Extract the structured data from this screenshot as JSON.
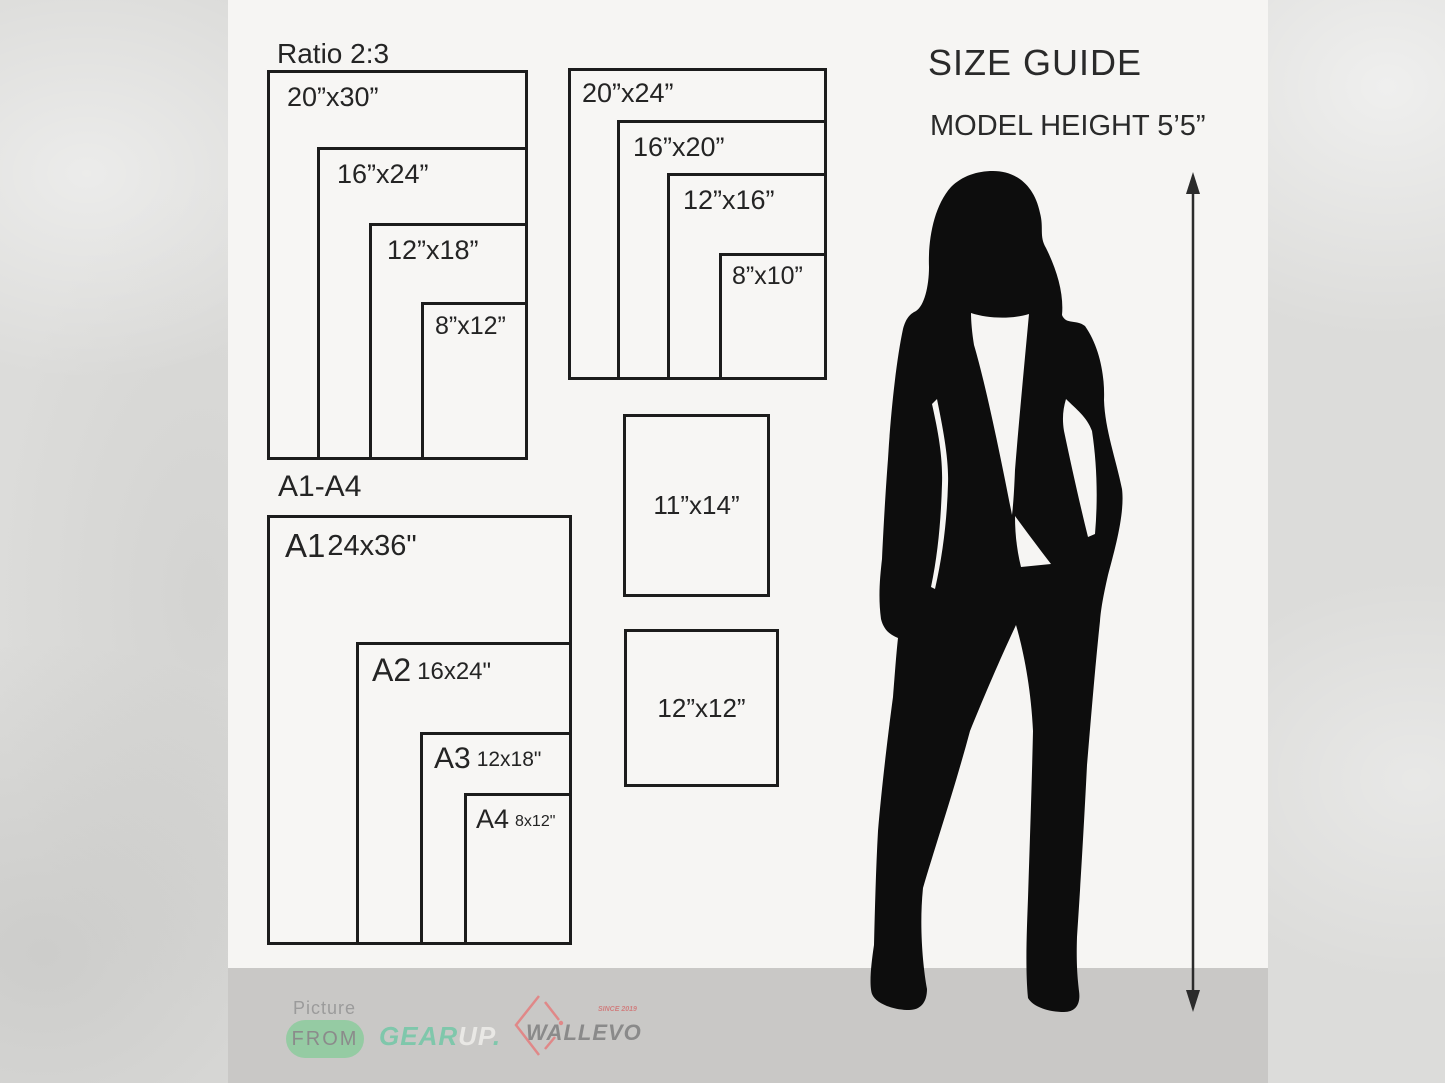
{
  "header": {
    "title": "SIZE GUIDE",
    "model_height": "MODEL HEIGHT 5’5”"
  },
  "groups": {
    "ratio23": {
      "title": "Ratio 2:3",
      "sizes": [
        "20”x30”",
        "16”x24”",
        "12”x18”",
        "8”x12”"
      ]
    },
    "standard": {
      "sizes": [
        "20”x24”",
        "16”x20”",
        "12”x16”",
        "8”x10”"
      ]
    },
    "a_series": {
      "title": "A1-A4",
      "sizes": [
        {
          "name": "A1",
          "dim": "24x36\""
        },
        {
          "name": "A2",
          "dim": "16x24\""
        },
        {
          "name": "A3",
          "dim": "12x18\""
        },
        {
          "name": "A4",
          "dim": "8x12\""
        }
      ]
    },
    "singles": [
      "11”x14”",
      "12”x12”"
    ]
  },
  "footer": {
    "picture_label": "Picture",
    "from_label": "FROM",
    "gear": "GEAR",
    "up": "UP",
    "dot": ".",
    "brand": "WALLEVO",
    "since": "SINCE 2019"
  },
  "colors": {
    "ink": "#1c1c1c",
    "panel": "#f6f5f3",
    "footer_band": "#c9c8c6",
    "pill_green": "#95cba3",
    "gear_teal": "#7fc7ab",
    "brand_red": "#e08888"
  }
}
